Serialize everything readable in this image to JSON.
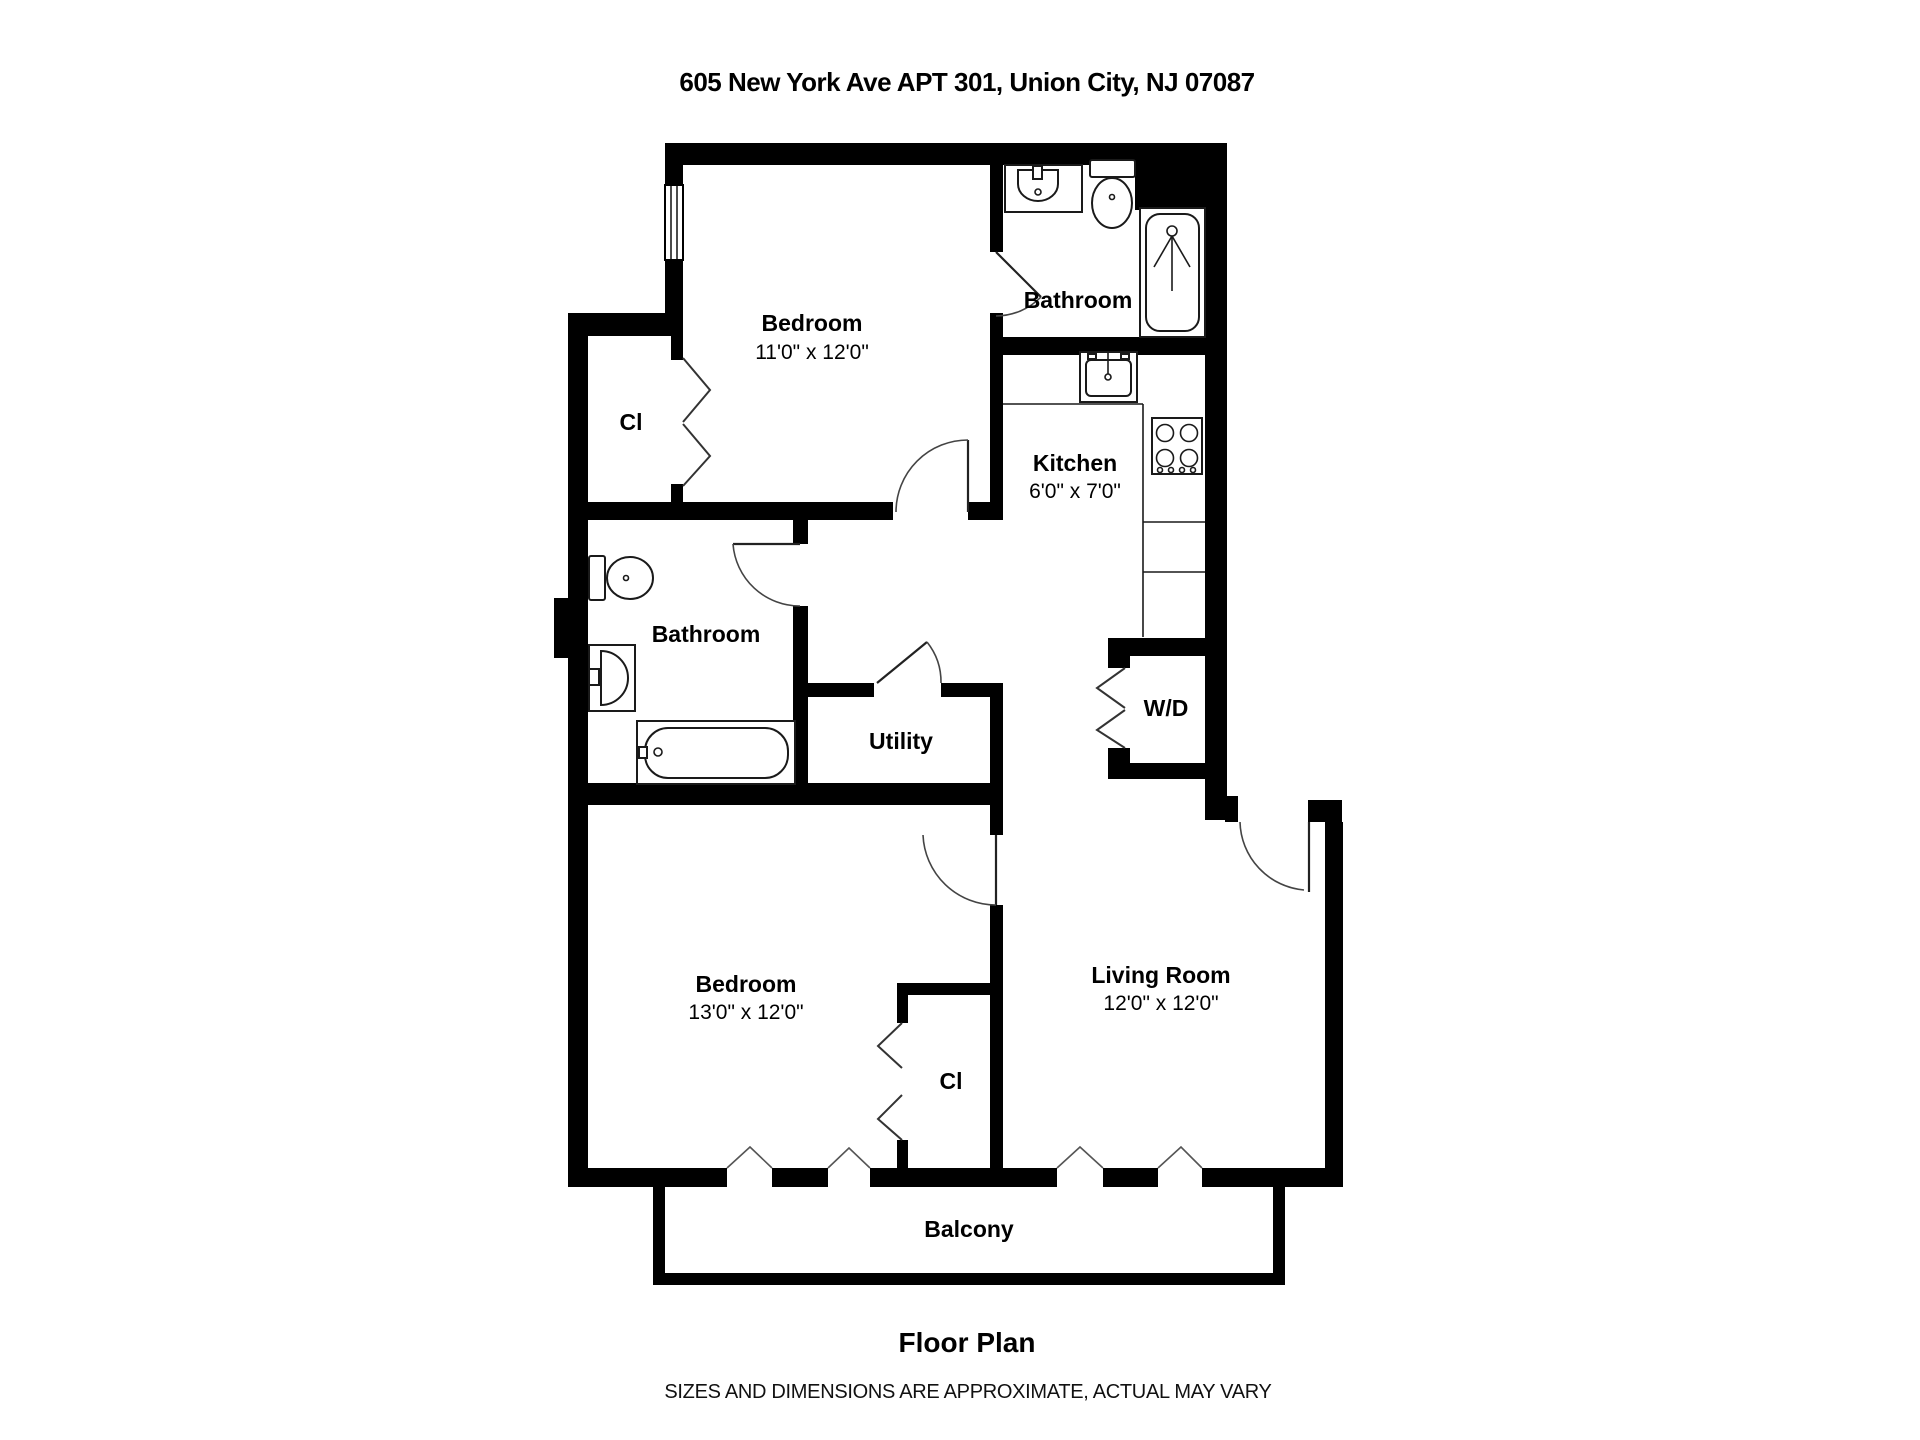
{
  "title": "605 New York Ave APT 301, Union City, NJ 07087",
  "rooms": {
    "bedroom1": {
      "name": "Bedroom",
      "dims": "11'0\" x 12'0\""
    },
    "bathroom1": {
      "name": "Bathroom"
    },
    "closet1": {
      "name": "Cl"
    },
    "kitchen": {
      "name": "Kitchen",
      "dims": "6'0\" x 7'0\""
    },
    "bathroom2": {
      "name": "Bathroom"
    },
    "utility": {
      "name": "Utility"
    },
    "washer_dryer": {
      "name": "W/D"
    },
    "bedroom2": {
      "name": "Bedroom",
      "dims": "13'0\" x 12'0\""
    },
    "closet2": {
      "name": "Cl"
    },
    "living_room": {
      "name": "Living Room",
      "dims": "12'0\" x 12'0\""
    },
    "balcony": {
      "name": "Balcony"
    }
  },
  "footer": {
    "caption": "Floor Plan",
    "disclaimer": "SIZES AND DIMENSIONS ARE APPROXIMATE, ACTUAL MAY VARY"
  },
  "colors": {
    "wall": "#000000",
    "background": "#ffffff",
    "fixture_line": "#1a1a1a"
  }
}
